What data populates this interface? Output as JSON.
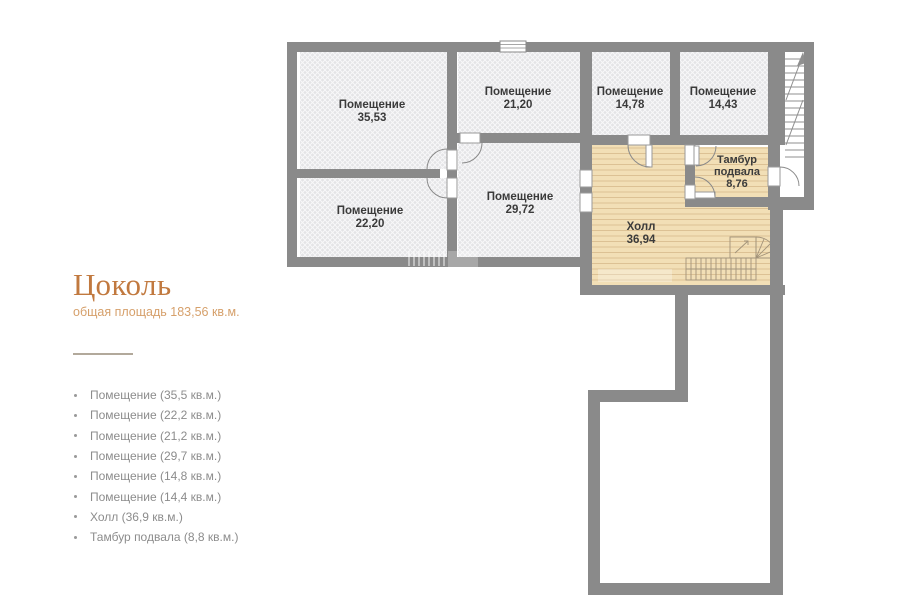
{
  "panel": {
    "title": "Цоколь",
    "subtitle": "общая площадь 183,56 кв.м.",
    "legend": [
      "Помещение (35,5 кв.м.)",
      "Помещение (22,2 кв.м.)",
      "Помещение (21,2 кв.м.)",
      "Помещение (29,7 кв.м.)",
      "Помещение (14,8 кв.м.)",
      "Помещение (14,4 кв.м.)",
      "Холл (36,9 кв.м.)",
      "Тамбур подвала (8,8 кв.м.)"
    ]
  },
  "plan": {
    "rooms": [
      {
        "name": "Помещение",
        "area": "35,53"
      },
      {
        "name": "Помещение",
        "area": "21,20"
      },
      {
        "name": "Помещение",
        "area": "14,78"
      },
      {
        "name": "Помещение",
        "area": "14,43"
      },
      {
        "name": "Помещение",
        "area": "22,20"
      },
      {
        "name": "Помещение",
        "area": "29,72"
      },
      {
        "name": "Холл",
        "area": "36,94"
      },
      {
        "name": "Тамбур",
        "line2": "подвала",
        "area": "8,76"
      }
    ],
    "colors": {
      "accent": "#c1793f",
      "wall": "#8a8a8a",
      "room_fill": "#e5e5e7",
      "wood_floor": "#f2dfb6",
      "label_text": "#3b3b3b",
      "legend_text": "#8c8c8c"
    }
  }
}
